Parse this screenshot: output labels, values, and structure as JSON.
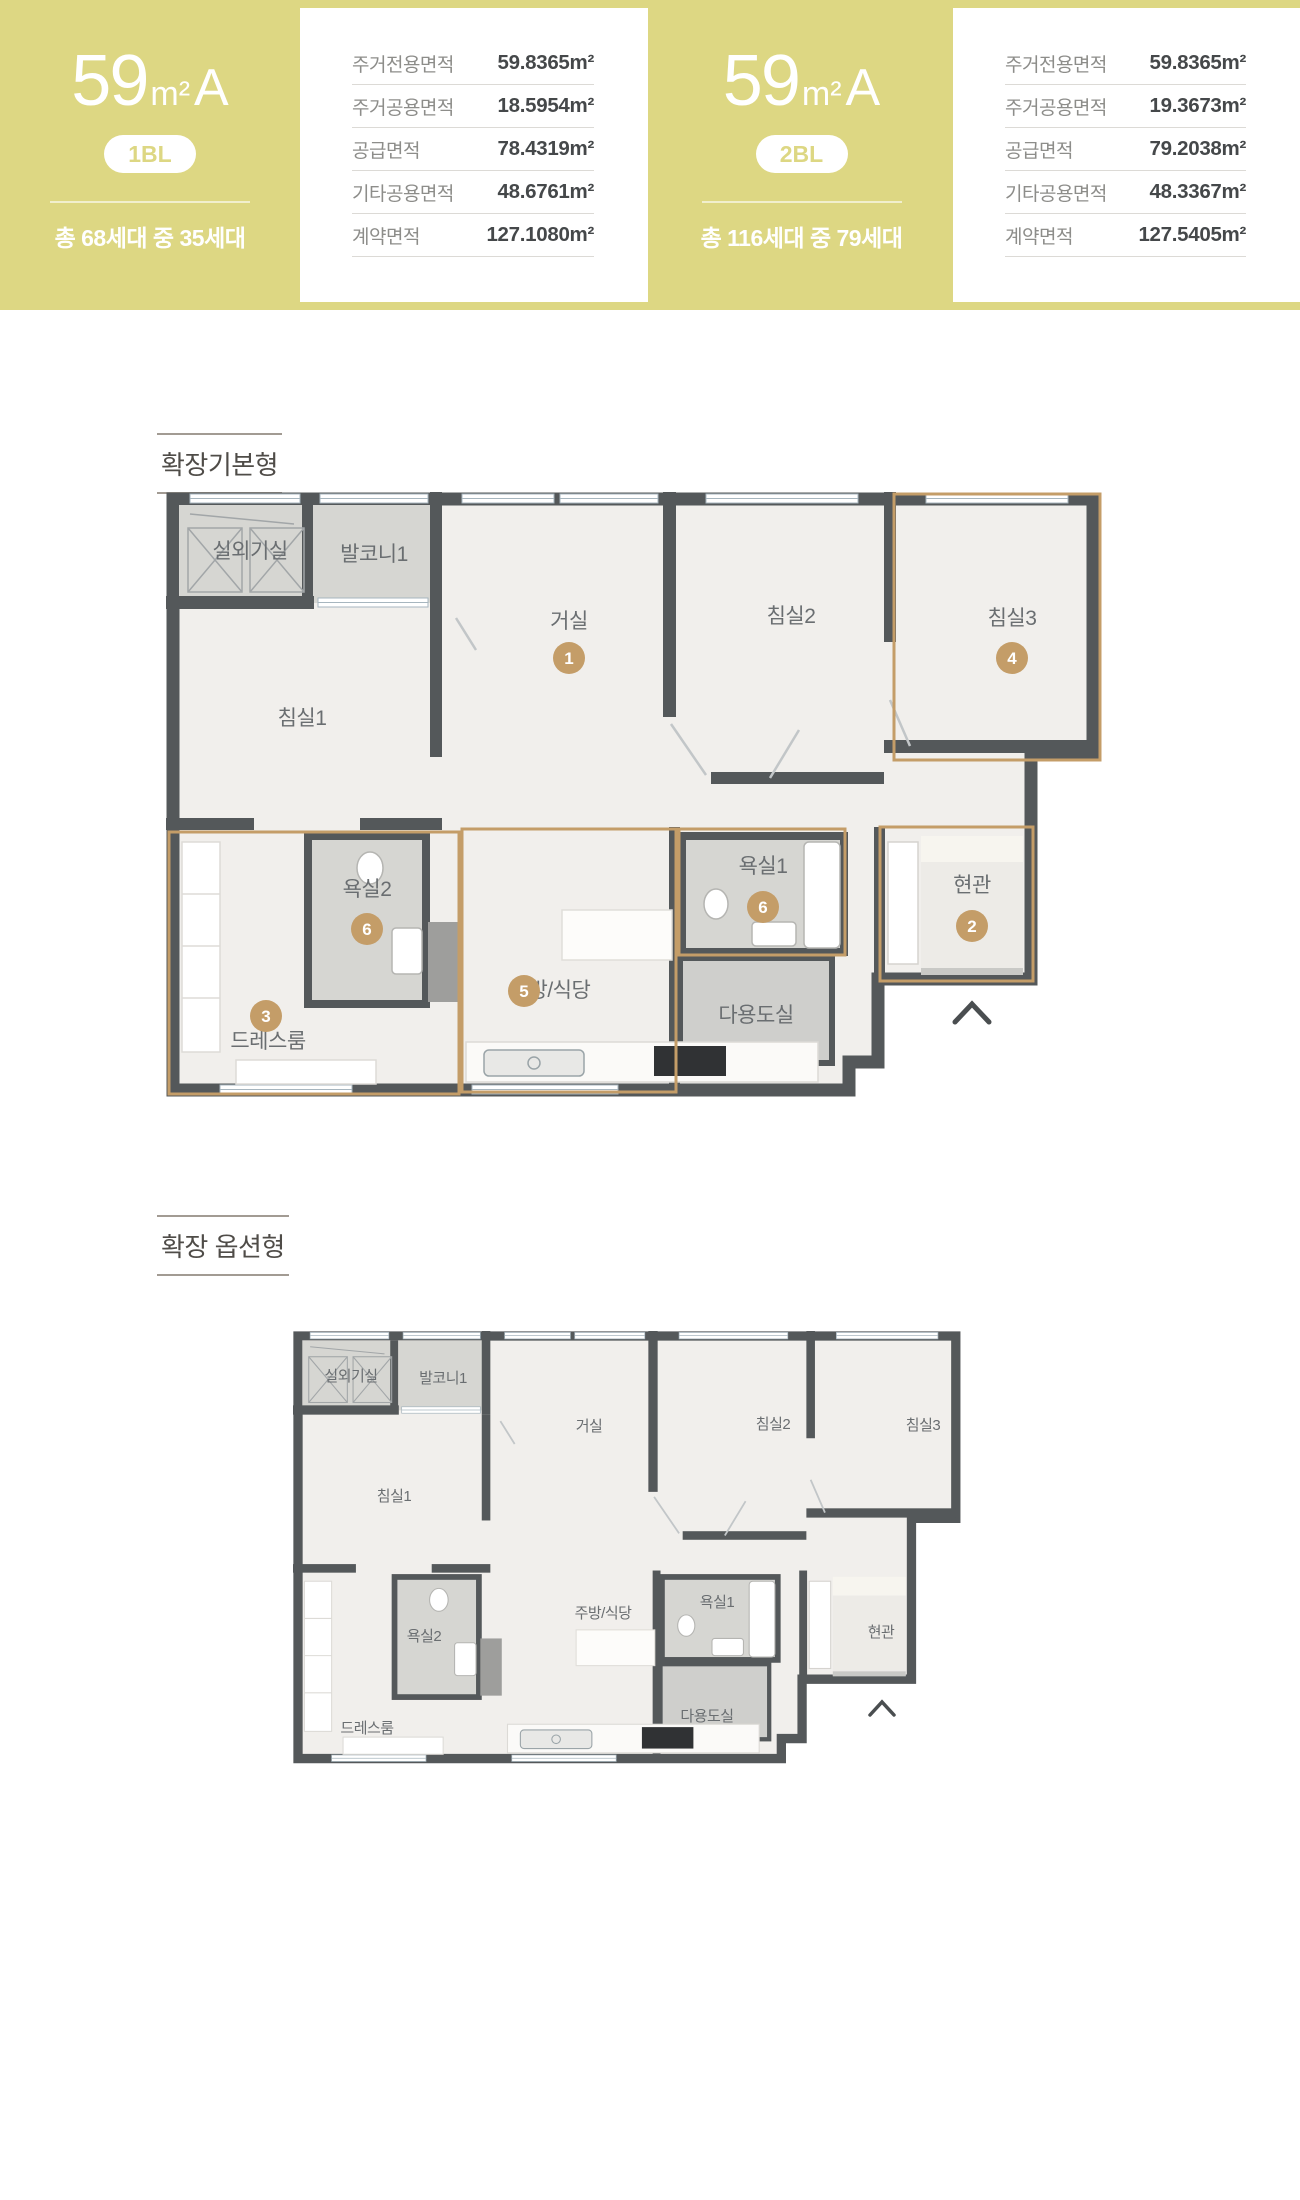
{
  "hero": {
    "units": [
      {
        "area_number": "59",
        "area_unit": "m²",
        "area_type": "A",
        "block": "1BL",
        "households": "총 68세대 중 35세대",
        "table": [
          {
            "label": "주거전용면적",
            "value": "59.8365m²"
          },
          {
            "label": "주거공용면적",
            "value": "18.5954m²"
          },
          {
            "label": "공급면적",
            "value": "78.4319m²"
          },
          {
            "label": "기타공용면적",
            "value": "48.6761m²"
          },
          {
            "label": "계약면적",
            "value": "127.1080m²"
          }
        ]
      },
      {
        "area_number": "59",
        "area_unit": "m²",
        "area_type": "A",
        "block": "2BL",
        "households": "총 116세대 중 79세대",
        "table": [
          {
            "label": "주거전용면적",
            "value": "59.8365m²"
          },
          {
            "label": "주거공용면적",
            "value": "19.3673m²"
          },
          {
            "label": "공급면적",
            "value": "79.2038m²"
          },
          {
            "label": "기타공용면적",
            "value": "48.3367m²"
          },
          {
            "label": "계약면적",
            "value": "127.5405m²"
          }
        ]
      }
    ]
  },
  "sections": [
    {
      "title": "확장기본형"
    },
    {
      "title": "확장 옵션형"
    }
  ],
  "rooms": {
    "outdoor": "실외기실",
    "balcony": "발코니1",
    "bed1": "침실1",
    "living": "거실",
    "bed2": "침실2",
    "bed3": "침실3",
    "bath2": "욕실2",
    "dress": "드레스룸",
    "kitchen": "주방/식당",
    "bath1": "욕실1",
    "utility": "다용도실",
    "entry": "현관"
  },
  "badges": {
    "living": "1",
    "entry": "2",
    "dress": "3",
    "bed3": "4",
    "kitchen": "5",
    "bath1": "6",
    "bath2": "6"
  },
  "colors": {
    "accent_yellow": "#ddd783",
    "accent_gold": "#c49d68",
    "wall": "#54585a",
    "floor": "#f1efec",
    "gray_room": "#d6d6d2",
    "label_text": "#6a6e71"
  }
}
